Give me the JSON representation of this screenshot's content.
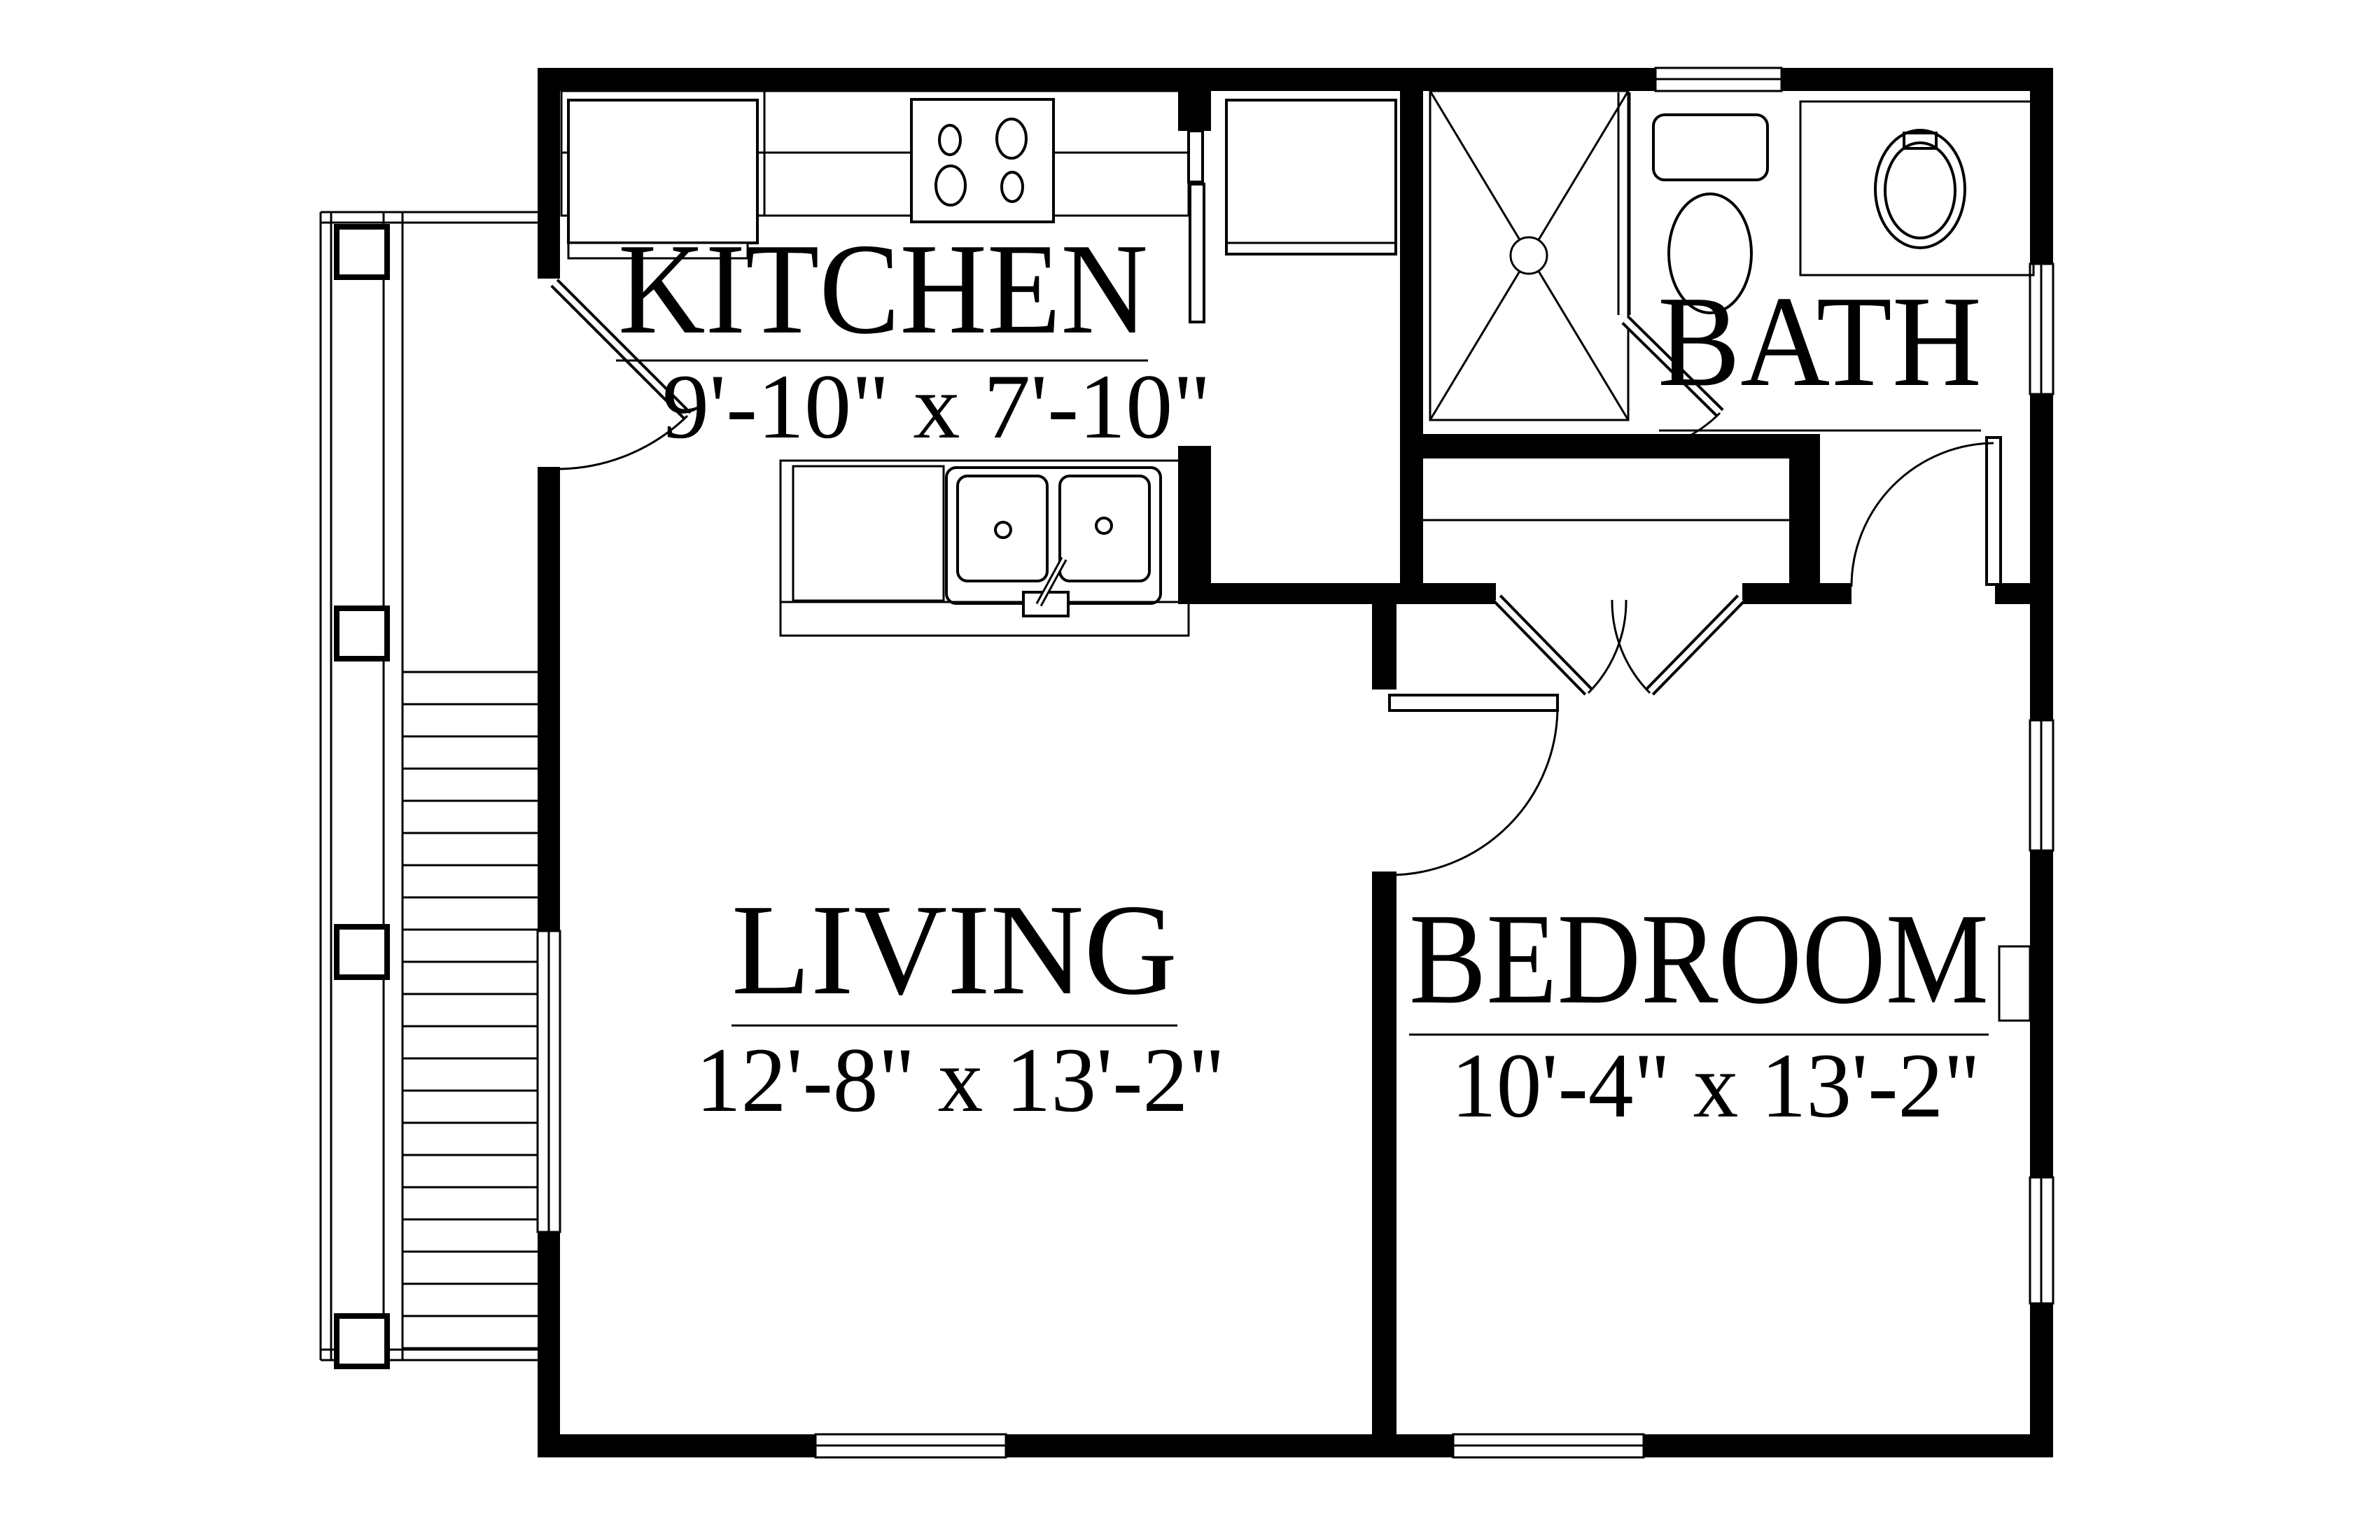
{
  "drawing_type": "apartment floor plan",
  "colors": {
    "wall": "#000000",
    "background": "#ffffff",
    "line": "#000000"
  },
  "rooms": {
    "kitchen": {
      "label": "KITCHEN",
      "dimensions": "9'-10\" x 7'-10\""
    },
    "living": {
      "label": "LIVING",
      "dimensions": "12'-8\" x 13'-2\""
    },
    "bedroom": {
      "label": "BEDROOM",
      "dimensions": "10'-4\" x 13'-2\""
    },
    "bath": {
      "label": "BATH"
    }
  }
}
